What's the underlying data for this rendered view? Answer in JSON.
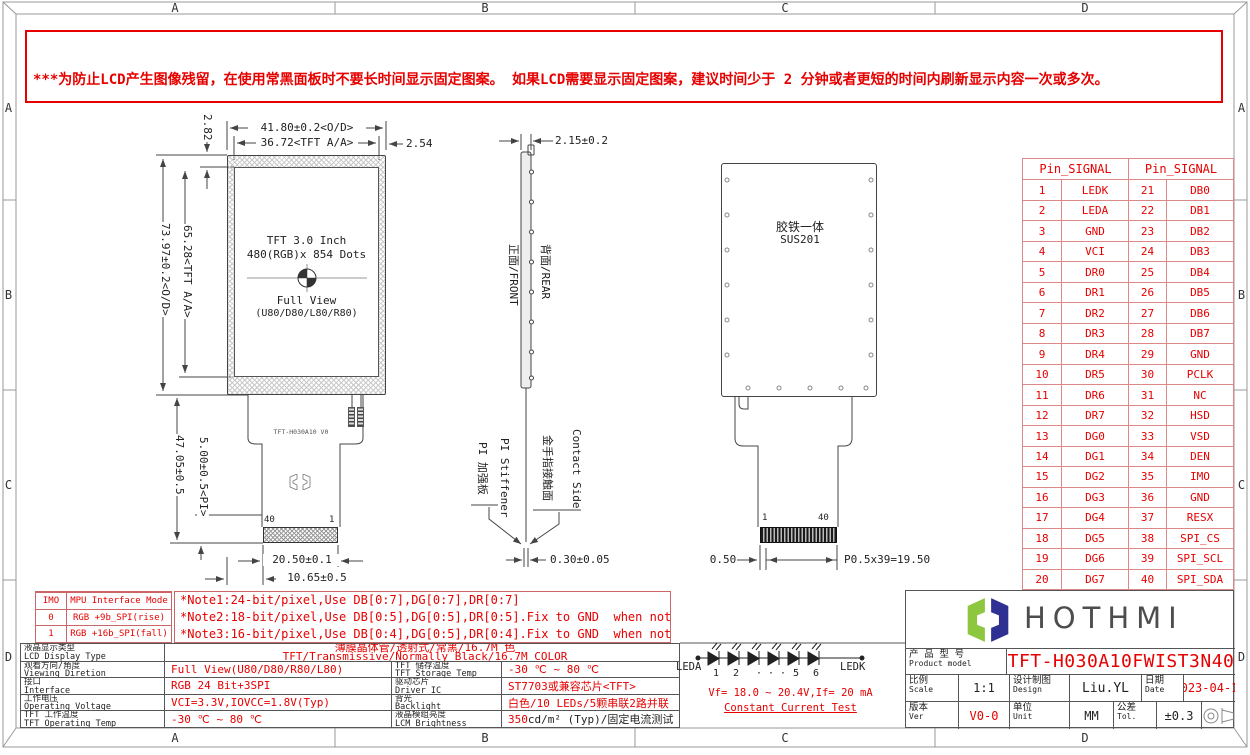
{
  "frame": {
    "zones": [
      "A",
      "B",
      "C",
      "D"
    ]
  },
  "warning": {
    "lines": [
      "***为防止LCD产生图像残留，在使用常黑面板时不要长时间显示固定图案。 如果LCD需要显示固定图案，建议时间少于 2 分钟或者更短的时间内刷新显示内容一次或多次。",
      "***In order to prevent the LCD from producing image retention, do not display a fixed pattern for a long time when using a normally black panel. If the",
      " LCD needs to display a fixed pattern, it is recommended to refresh the display one or more times in less than 2 minutes or less.",
      "强烈建议使用黑色图像或移动图像作为屏幕保护程序。It is strongly recommended to use a black image or moving image as a screen saver."
    ]
  },
  "front_view": {
    "center_line1": "TFT 3.0 Inch",
    "center_line2": "480(RGB)x 854 Dots",
    "center_line3": "Full View",
    "center_line4": "(U80/D80/L80/R80)",
    "fpc_label": "TFT-H030A10 V0",
    "pin_left": "40",
    "pin_right": "1",
    "dim_width_od": "41.80±0.2<O/D>",
    "dim_width_aa": "36.72<TFT A/A>",
    "dim_right_margin": "2.54",
    "dim_top_margin": "2.82",
    "dim_height_od": "73.97±0.2<O/D>",
    "dim_height_aa": "65.28<TFT A/A>",
    "dim_fpc_length": "47.05±0.5",
    "dim_pi": "5.00±0.5<PI>",
    "dim_connector_width": "20.50±0.1",
    "dim_connector_offset": "10.65±0.5"
  },
  "side_view": {
    "dim_thickness": "2.15±0.2",
    "dim_fpc_thickness": "0.30±0.05",
    "label_front": "正面/FRONT",
    "label_rear": "背面/REAR",
    "label_pi_cn": "PI 加强板",
    "label_pi_en": "PI Stiffener",
    "label_contact_cn": "金手指接触面",
    "label_contact_en": "Contact Side"
  },
  "rear_view": {
    "material_line1": "胶铁一体",
    "material_line2": "SUS201",
    "pin_left": "1",
    "pin_right": "40",
    "dim_edge": "0.50",
    "dim_pitch_total": "P0.5x39=19.50"
  },
  "pin_table": {
    "header_left": "Pin_SIGNAL",
    "header_right": "Pin_SIGNAL",
    "rows": [
      [
        "1",
        "LEDK",
        "21",
        "DB0"
      ],
      [
        "2",
        "LEDA",
        "22",
        "DB1"
      ],
      [
        "3",
        "GND",
        "23",
        "DB2"
      ],
      [
        "4",
        "VCI",
        "24",
        "DB3"
      ],
      [
        "5",
        "DR0",
        "25",
        "DB4"
      ],
      [
        "6",
        "DR1",
        "26",
        "DB5"
      ],
      [
        "7",
        "DR2",
        "27",
        "DB6"
      ],
      [
        "8",
        "DR3",
        "28",
        "DB7"
      ],
      [
        "9",
        "DR4",
        "29",
        "GND"
      ],
      [
        "10",
        "DR5",
        "30",
        "PCLK"
      ],
      [
        "11",
        "DR6",
        "31",
        "NC"
      ],
      [
        "12",
        "DR7",
        "32",
        "HSD"
      ],
      [
        "13",
        "DG0",
        "33",
        "VSD"
      ],
      [
        "14",
        "DG1",
        "34",
        "DEN"
      ],
      [
        "15",
        "DG2",
        "35",
        "IMO"
      ],
      [
        "16",
        "DG3",
        "36",
        "GND"
      ],
      [
        "17",
        "DG4",
        "37",
        "RESX"
      ],
      [
        "18",
        "DG5",
        "38",
        "SPI_CS"
      ],
      [
        "19",
        "DG6",
        "39",
        "SPI_SCL"
      ],
      [
        "20",
        "DG7",
        "40",
        "SPI_SDA"
      ]
    ]
  },
  "imo_table": {
    "rows": [
      [
        "IMO",
        "MPU Interface Mode"
      ],
      [
        "0",
        "RGB +9b_SPI(rise)"
      ],
      [
        "1",
        "RGB +16b_SPI(fall)"
      ]
    ]
  },
  "notes": {
    "lines": [
      "*Note1:24-bit/pixel,Use DB[0:7],DG[0:7],DR[0:7]",
      "*Note2:18-bit/pixel,Use DB[0:5],DG[0:5],DR[0:5].Fix to GND  when not in use.",
      "*Note3:16-bit/pixel,Use DB[0:4],DG[0:5],DR[0:4].Fix to GND  when not in use."
    ]
  },
  "spec_table": {
    "rows": [
      {
        "label_cn": "液晶显示类型",
        "label_en": "LCD Display Type",
        "value_cn": "薄膜晶体管/透射式/常黑/16.7M 色",
        "value_en": "TFT/Transmissive/Normally Black/16.7M COLOR"
      },
      {
        "label_cn": "观看方向/角度",
        "label_en": "Viewing Diretion",
        "value": "Full View(U80/D80/R80/L80)",
        "label2_cn": "TFT 储存温度",
        "label2_en": "TFT Storage Temp",
        "value2": "-30 ℃ ~ 80 ℃"
      },
      {
        "label_cn": "接口",
        "label_en": "Interface",
        "value": "RGB 24 Bit+3SPI",
        "label2_cn": "驱动芯片",
        "label2_en": "Driver IC",
        "value2": "ST7703或兼容芯片<TFT>"
      },
      {
        "label_cn": "工作电压",
        "label_en": "Operating Voltage",
        "value": "VCI=3.3V,IOVCC=1.8V(Typ)",
        "label2_cn": "背光",
        "label2_en": "Backlight",
        "value2": "白色/10 LEDs/5颗串联2路并联"
      },
      {
        "label_cn": "TFT 工作温度",
        "label_en": "TFT Operating Temp",
        "value": "-30 ℃ ~ 80 ℃",
        "label2_cn": "液晶模组亮度",
        "label2_en": "LCM Brightness",
        "value2_red": "350",
        "value2_rest": " cd/m² (Typ)/固定电流测试"
      }
    ]
  },
  "led_circuit": {
    "anode": "LEDA",
    "cathode": "LEDK",
    "numbers": [
      "1",
      "2",
      "· · ·",
      "5",
      "6"
    ],
    "spec": "Vf= 18.0 ~ 20.4V,If= 20 mA",
    "test": "Constant Current Test"
  },
  "title_block": {
    "brand": "HOTHMI",
    "product_label_cn": "产 品 型 号",
    "product_label_en": "Product model",
    "product_model": "TFT-H030A10FWIST3N40",
    "scale_cn": "比例",
    "scale_en": "Scale",
    "scale_value": "1:1",
    "design_cn": "设计制图",
    "design_en": "Design",
    "design_value": "Liu.YL",
    "date_cn": "日期",
    "date_en": "Date",
    "date_value": "2023-04-10",
    "ver_cn": "版本",
    "ver_en": "Ver",
    "ver_value": "V0-0",
    "unit_cn": "单位",
    "unit_en": "Unit",
    "unit_value": "MM",
    "tol_cn": "公差",
    "tol_en": "Tol.",
    "tol_value": "±0.3"
  }
}
